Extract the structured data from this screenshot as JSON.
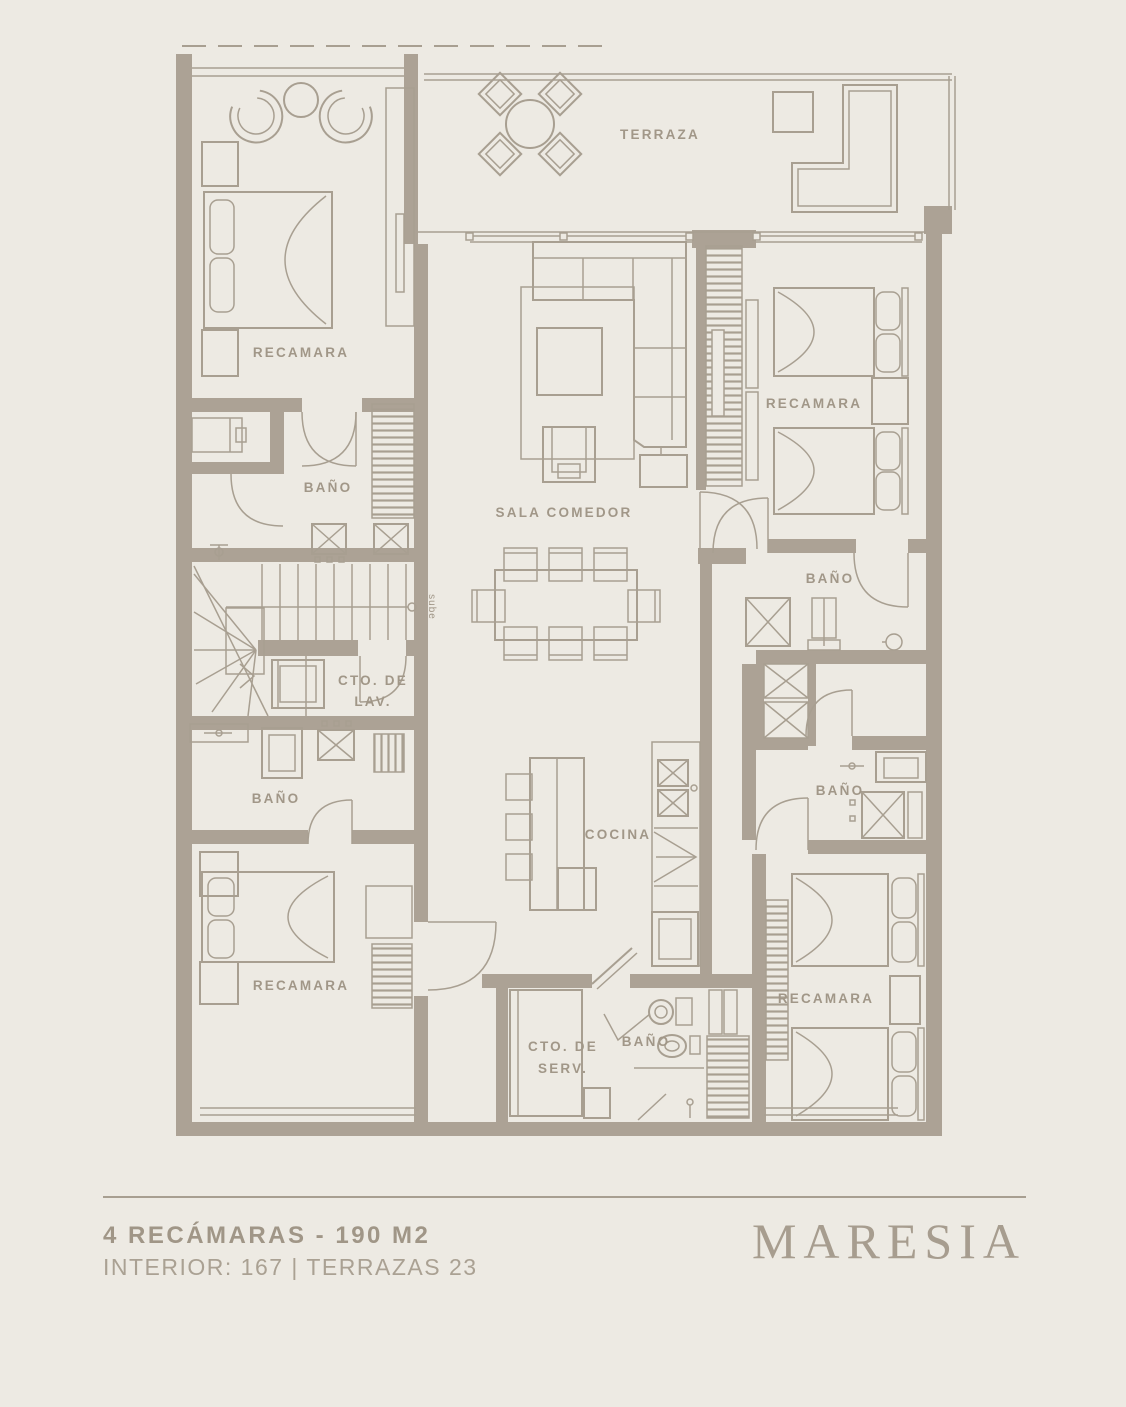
{
  "colors": {
    "background": "#edeae3",
    "wall": "#aca295",
    "line": "#a89f91",
    "label_text": "#a19788"
  },
  "plan": {
    "rooms": [
      {
        "id": "terraza",
        "label": "TERRAZA"
      },
      {
        "id": "recamara-principal",
        "label": "RECAMARA"
      },
      {
        "id": "bano-principal",
        "label": "BAÑO"
      },
      {
        "id": "sala-comedor",
        "label": "SALA COMEDOR"
      },
      {
        "id": "recamara-2",
        "label": "RECAMARA"
      },
      {
        "id": "bano-2",
        "label": "BAÑO"
      },
      {
        "id": "cuarto-lavado",
        "label_line1": "CTO. DE",
        "label_line2": "LAV."
      },
      {
        "id": "bano-3",
        "label": "BAÑO"
      },
      {
        "id": "cocina",
        "label": "COCINA"
      },
      {
        "id": "recamara-3",
        "label": "RECAMARA"
      },
      {
        "id": "cuarto-servicio",
        "label_line1": "CTO. DE",
        "label_line2": "SERV."
      },
      {
        "id": "bano-4",
        "label": "BAÑO"
      },
      {
        "id": "bano-5",
        "label": "BAÑO"
      },
      {
        "id": "recamara-4",
        "label": "RECAMARA"
      }
    ],
    "stairs": {
      "direction_label": "sube"
    }
  },
  "footer": {
    "title": "4 RECÁMARAS - 190 M2",
    "subtitle": "INTERIOR: 167 | TERRAZAS 23",
    "brand": "MARESIA"
  }
}
